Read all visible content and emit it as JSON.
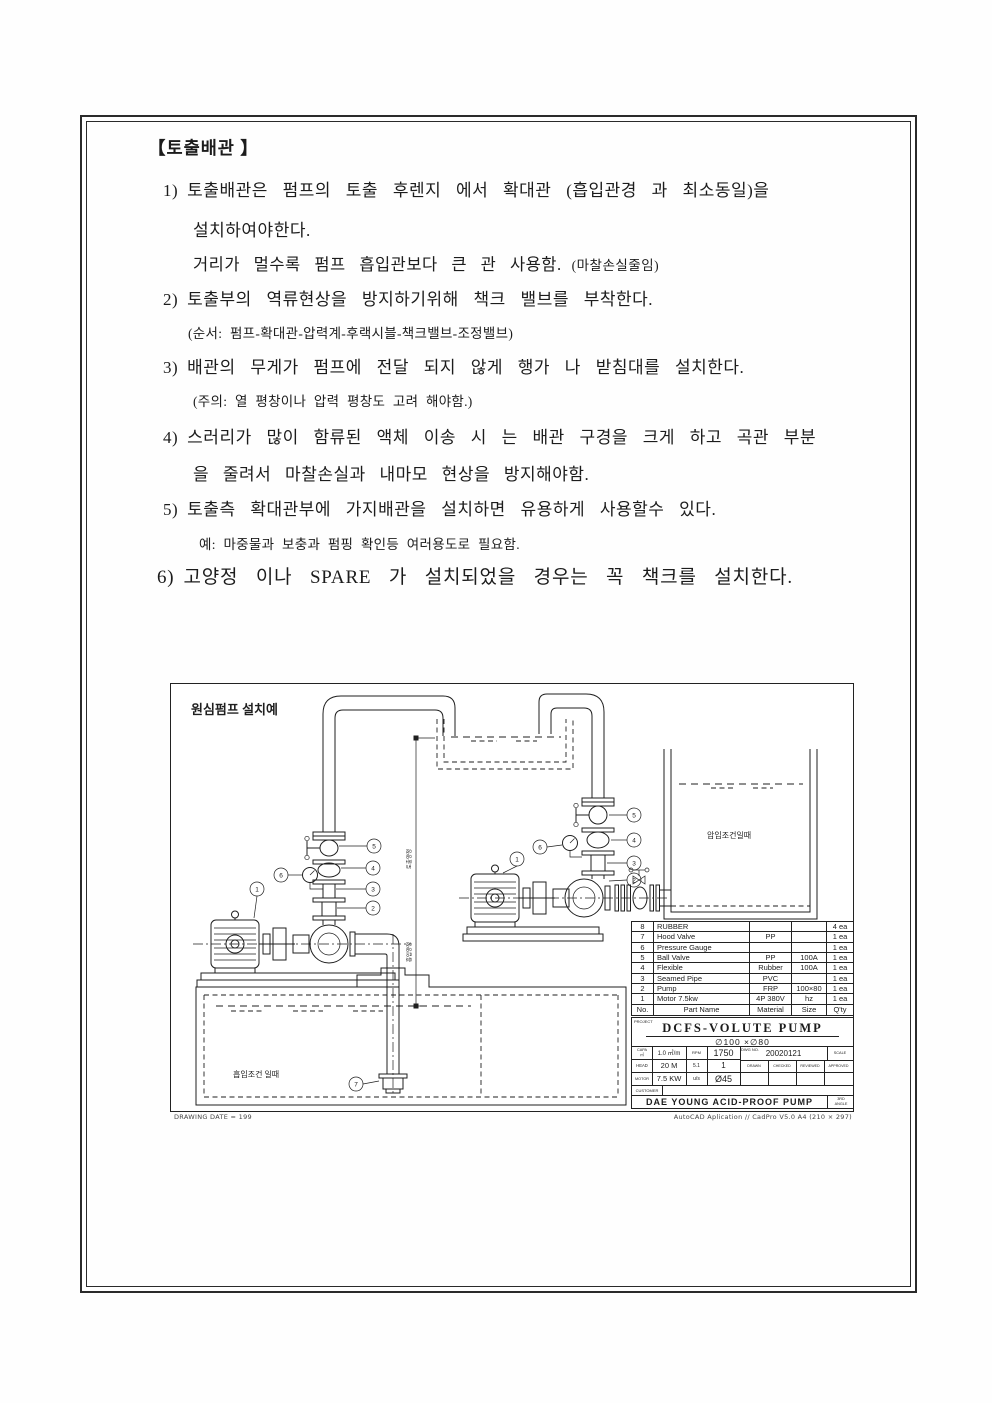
{
  "doc": {
    "title": "【토출배관 】",
    "i1_num": "1)",
    "i1_l1": "토출배관은 펌프의 토출 후렌지 에서 확대관 (흡입관경 과 최소동일)을",
    "i1_l2": "설치하여야한다.",
    "i1_l3a": "거리가 멀수록 펌프 흡입관보다 큰 관 사용함.",
    "i1_l3b": "(마찰손실줄임)",
    "i2_num": "2)",
    "i2_l1": "토출부의 역류현상을 방지하기위해 책크 밸브를 부착한다.",
    "i2_note": "(순서: 펌프-확대관-압력계-후랙시블-책크밸브-조정밸브)",
    "i3_num": "3)",
    "i3_l1": "배관의 무게가 펌프에 전달 되지 않게 행가 나 받침대를 설치한다.",
    "i3_note": "(주의: 열 평창이나 압력 평창도 고려 해야함.)",
    "i4_num": "4)",
    "i4_l1": "스러리가 많이 함류된 액체 이송 시 는 배관 구경을 크게 하고 곡관 부분",
    "i4_l2": "을 줄려서 마찰손실과 내마모 현상을 방지해야함.",
    "i5_num": "5)",
    "i5_l1": "토출측 확대관부에 가지배관을 설치하면 유용하게 사용할수 있다.",
    "i5_note": "예: 마중물과 보충과 펌핑 확인등 여러용도로 필요함.",
    "i6_num": "6)",
    "i6_l1": "고양정 이나 SPARE 가 설치되었을 경우는 꼭 책크를 설치한다."
  },
  "drawing": {
    "title": "원심펌프 설치예",
    "label_suction_tank": "흡입조건 일때",
    "label_pressure_tank": "압입조건일때",
    "dim_label_top": "토출양정",
    "dim_label_bottom": "흡입양정",
    "c1": "1",
    "c2": "2",
    "c3": "3",
    "c4": "4",
    "c5": "5",
    "c6": "6",
    "c7": "7",
    "footer_left": "DRAWING DATE = 199",
    "footer_right": "AutoCAD Aplication // CadPro V5.0 A4 (210 × 297)"
  },
  "parts_table": {
    "rows": [
      [
        "8",
        "RUBBER",
        "",
        "",
        "4 ea"
      ],
      [
        "7",
        "Hood Valve",
        "PP",
        "",
        "1 ea"
      ],
      [
        "6",
        "Pressure Gauge",
        "",
        "",
        "1 ea"
      ],
      [
        "5",
        "Ball Valve",
        "PP",
        "100A",
        "1 ea"
      ],
      [
        "4",
        "Flexible",
        "Rubber",
        "100A",
        "1 ea"
      ],
      [
        "3",
        "Seamed Pipe",
        "PVC",
        "",
        "1 ea"
      ],
      [
        "2",
        "Pump",
        "FRP",
        "100×80",
        "1 ea"
      ],
      [
        "1",
        "Motor   7.5kw",
        "4P 380V",
        "hz",
        "1 ea"
      ],
      [
        "No.",
        "Part Name",
        "Material",
        "Size",
        "Q'ty"
      ]
    ]
  },
  "title_block": {
    "project_label": "PROJECT",
    "name": "DCFS-VOLUTE PUMP",
    "size_line": "∅100 ×∅80",
    "capa_label": "CAPA",
    "capa_unit": "㎥",
    "capa_val": "1.0 ㎥/m",
    "rpm_label": "RPM",
    "rpm_val": "1750",
    "head_label": "HEAD",
    "head_val": "20 M",
    "head_c3": "5.1",
    "head_c4": "1",
    "motor_label": "MOTOR",
    "motor_val": "7.5 KW",
    "motor_c3": "u/s",
    "motor_c4": "Ø45",
    "dwg_label": "DWG NO.",
    "dwg_no": "20020121",
    "scale_label": "SCALE",
    "sign1": "DRAWN",
    "sign2": "CHECKED",
    "sign3": "REVIEWED",
    "sign4": "APPROVED",
    "customer_label": "CUSTOMER",
    "company": "DAE YOUNG ACID-PROOF PUMP",
    "angle1": "3RD",
    "angle2": "ANGLE"
  }
}
